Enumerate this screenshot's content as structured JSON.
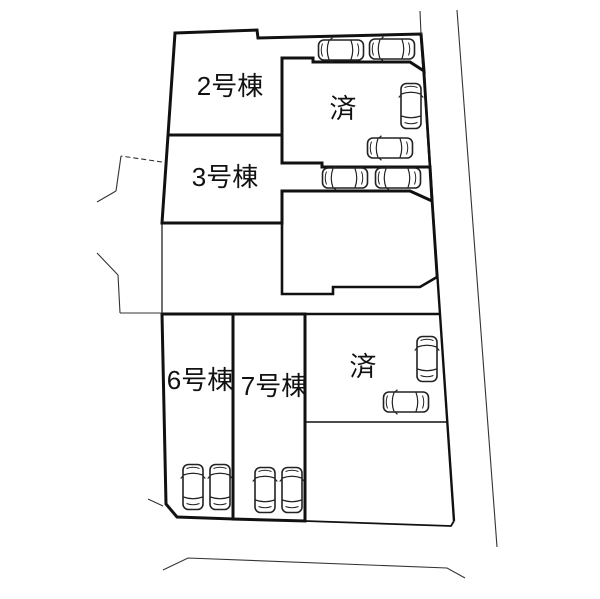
{
  "diagram": {
    "type": "real-estate-site-plan",
    "orientation": "road on right and bottom, neighbor parcels on left"
  },
  "labels": {
    "plot2": "2号棟",
    "plot3": "3号棟",
    "plot6": "6号棟",
    "plot7": "7号棟",
    "sold_top": "済",
    "sold_bottom": "済"
  },
  "plots": [
    {
      "name": "2号棟",
      "status": "for-sale",
      "position": "upper-left",
      "cars": 0
    },
    {
      "name": "3号棟",
      "status": "for-sale",
      "position": "middle-left",
      "cars": 0
    },
    {
      "name": "6号棟",
      "status": "for-sale",
      "position": "lower-left",
      "cars": 2
    },
    {
      "name": "7号棟",
      "status": "for-sale",
      "position": "lower-middle",
      "cars": 2
    },
    {
      "name": "済",
      "status": "sold",
      "position": "upper-right",
      "cars": 2
    },
    {
      "name": "",
      "status": "vacant-lot",
      "position": "middle-right",
      "cars": 0
    },
    {
      "name": "済",
      "status": "sold",
      "position": "lower-right",
      "cars": 2
    }
  ],
  "parking": {
    "top_strip_cars": 2,
    "middle_strip_cars": 2,
    "total_cars": 12
  },
  "colors": {
    "plot_green": "#dce8d8",
    "boundary": "#111111",
    "thin_line": "#333333",
    "car_fill": "#ffffff",
    "background": "#ffffff"
  }
}
